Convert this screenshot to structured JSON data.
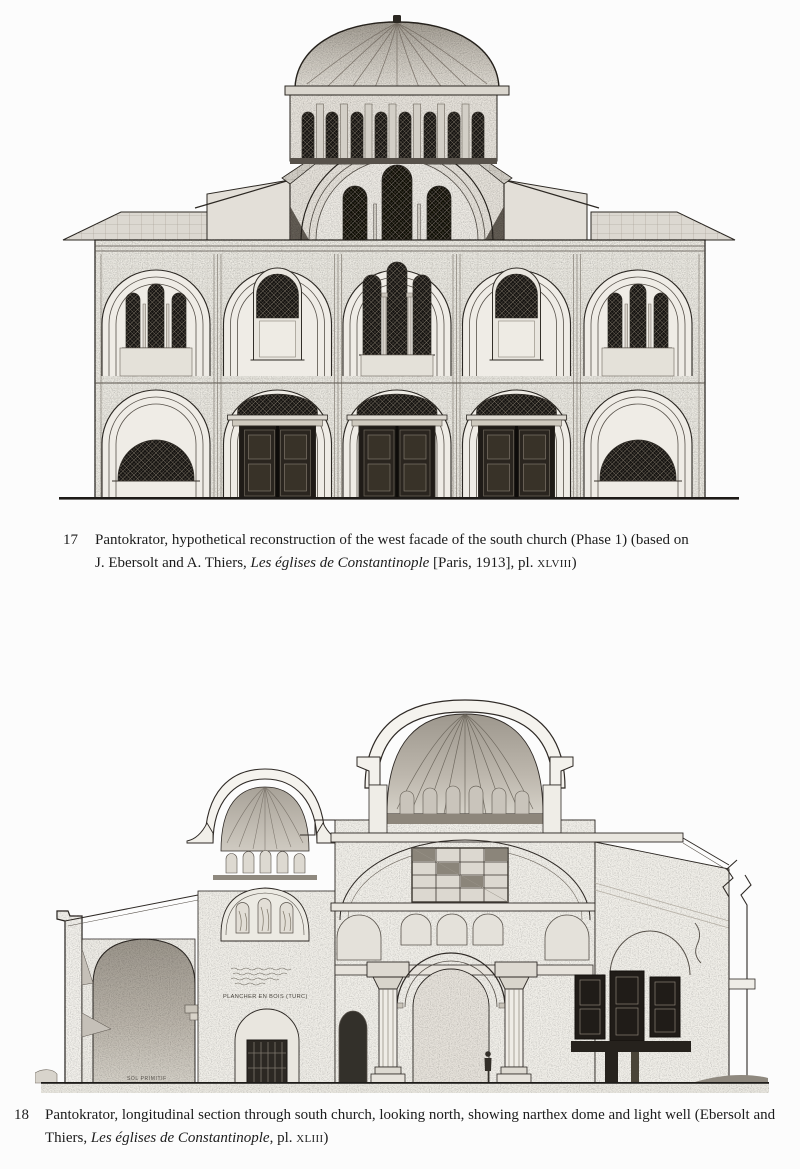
{
  "page": {
    "background": "#fcfcfc",
    "ink": "#1e1e1e"
  },
  "figures": [
    {
      "number": "17",
      "line1": "Pantokrator, hypothetical reconstruction of the west facade of the south church (Phase 1) (based on",
      "line2_pre": "J. Ebersolt and A. Thiers, ",
      "italic": "Les églises de Constantinople",
      "line2_mid": " [Paris, 1913], pl. ",
      "plate": "xlviii",
      "line2_end": ")"
    },
    {
      "number": "18",
      "line1": "Pantokrator, longitudinal section through south church, looking north, showing narthex dome and light well (Ebersolt and",
      "line2_pre": "Thiers, ",
      "italic": "Les églises de Constantinople",
      "line2_mid": ", pl. ",
      "plate": "xliii",
      "line2_end": ")"
    }
  ],
  "drawing_annotations": {
    "plancher": "PLANCHER EN BOIS (TURC)",
    "sol": "SOL PRIMITIF"
  }
}
